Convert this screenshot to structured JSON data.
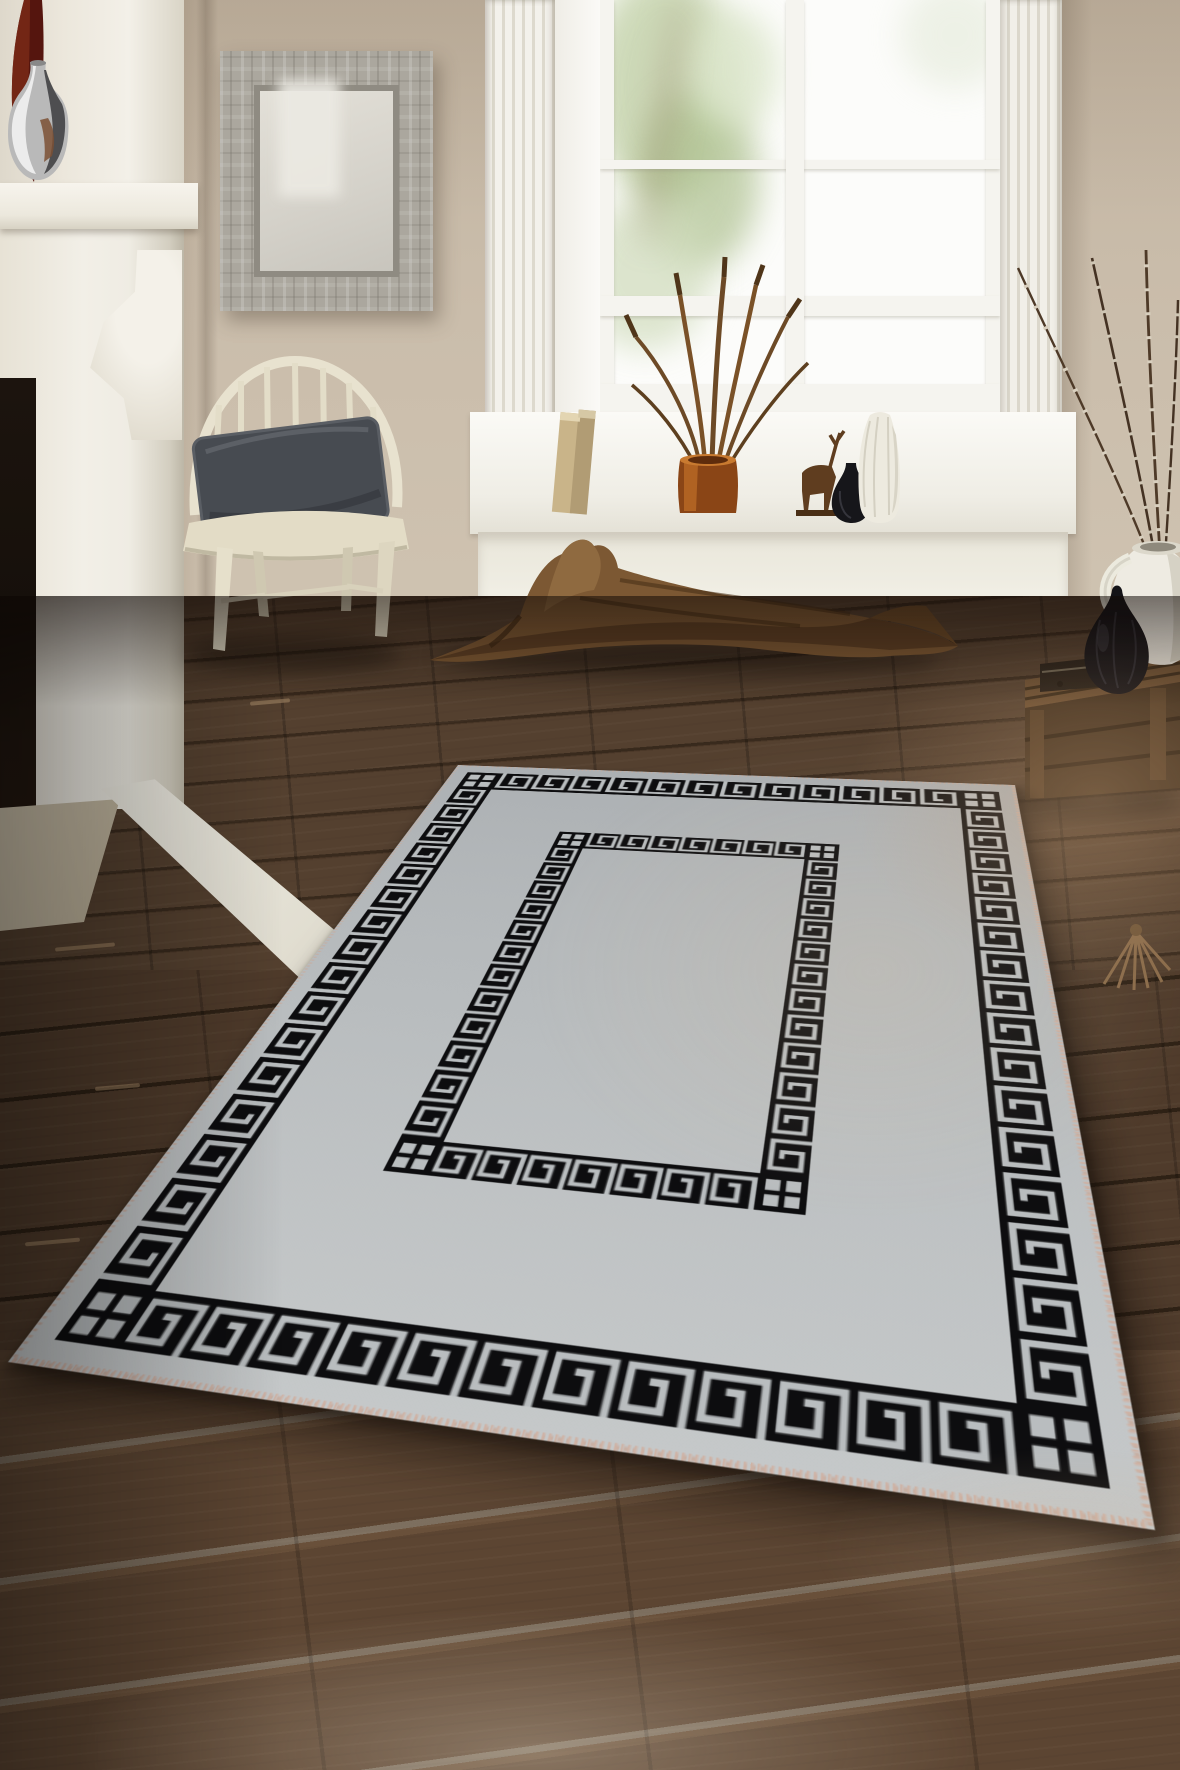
{
  "scene": {
    "type": "natural-image",
    "description": "Product photo of a light gray rectangular area rug with a black Greek key meander border and an inner Greek key rectangle, laid diagonally on a dark walnut plank floor in a beige living room with a white fireplace mantel, a distressed wood mirror, a cream Windsor chair with a charcoal velvet cushion, a bright sash window with decorative vases on the deep sill, a large piece of driftwood along the wall, and a rustic wooden pallet holding a white jug of pussy-willow branches and a black teardrop vase."
  },
  "product": {
    "name": "Greek key bordered area rug",
    "pattern": "greek-key-meander",
    "field_color": "light gray",
    "pattern_color": "black",
    "border_style": "outer meander band with checkered corner blocks plus matching inner rectangle"
  },
  "objects": {
    "rug": {
      "label": "Gray rug with black Greek key border"
    },
    "mirror": {
      "label": "Distressed wood framed mirror"
    },
    "chair": {
      "label": "Cream Windsor chair with gray velvet pillow"
    },
    "window": {
      "label": "White sash window with garden view"
    },
    "fireplace": {
      "label": "White fireplace mantel"
    },
    "driftwood": {
      "label": "Decorative driftwood branch"
    },
    "pallet": {
      "label": "Rustic wooden pallet with white jug and black vase"
    },
    "willow": {
      "label": "Pussy willow branches"
    },
    "silver_vase": {
      "label": "Polished silver vase on mantel"
    },
    "red_board": {
      "label": "Dark red decor piece on mantel"
    },
    "sill_items": {
      "label": "Books, amber vase with dried plant, deer figurine, black and white vases on windowsill"
    },
    "tassel": {
      "label": "Small tassel on floor"
    },
    "floor": {
      "label": "Dark walnut wood plank floor"
    }
  },
  "colors": {
    "wall": "#c7b9a7",
    "trim": "#f2efe7",
    "floor-dark": "#463426",
    "rug-gray": "#b8bcbe",
    "rug-black": "#0d0d0f",
    "fringe": "#c8ab9d",
    "pillow": "#4b4f55",
    "chair": "#e7e1cd",
    "wood": "#7c5833",
    "amber": "#9c521d",
    "crate": "#4e3a26"
  }
}
